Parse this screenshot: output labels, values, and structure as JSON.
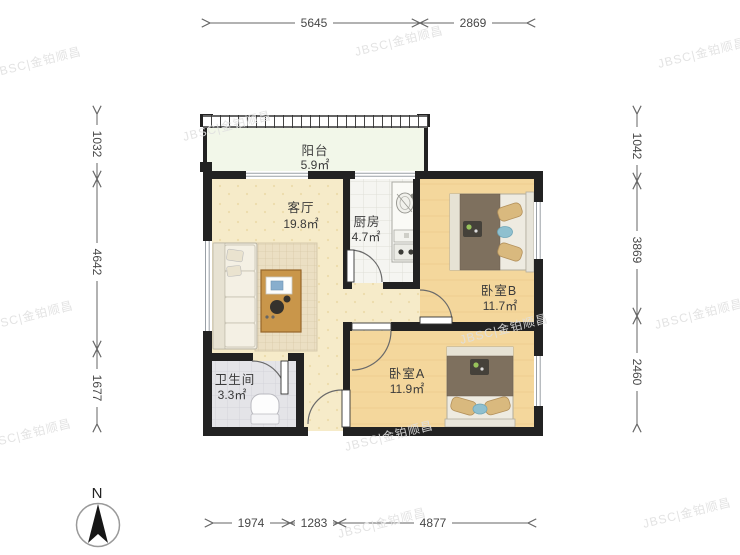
{
  "compass": {
    "label": "N"
  },
  "watermark": {
    "text": "JBSC|金铂顺昌"
  },
  "rooms": {
    "balcony": {
      "name": "阳台",
      "area": "5.9㎡"
    },
    "living": {
      "name": "客厅",
      "area": "19.8㎡"
    },
    "kitchen": {
      "name": "厨房",
      "area": "4.7㎡"
    },
    "bedroom_b": {
      "name": "卧室B",
      "area": "11.7㎡"
    },
    "bedroom_a": {
      "name": "卧室A",
      "area": "11.9㎡"
    },
    "bathroom": {
      "name": "卫生间",
      "area": "3.3㎡"
    }
  },
  "dimensions": {
    "top": [
      "5645",
      "2869"
    ],
    "bottom": [
      "1974",
      "1283",
      "4877"
    ],
    "left": [
      "1032",
      "4642",
      "1677"
    ],
    "right": [
      "1042",
      "3869",
      "2460"
    ]
  },
  "colors": {
    "wall": "#222222",
    "living_floor": "#f6ebc9",
    "bedroom_floor": "#f4d79c",
    "balcony_floor": "#f2f7e9",
    "kitchen_floor": "#f5f5f1",
    "bathroom_floor": "#e4e4e8",
    "dim_line": "#666666",
    "watermark": "#e0e0e0"
  }
}
